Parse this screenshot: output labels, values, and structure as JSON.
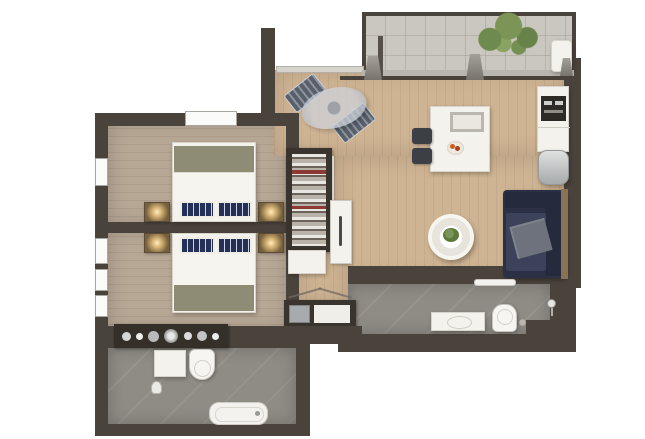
{
  "meta": {
    "title": "apartment-floor-plan",
    "view": "top-down-3d-render",
    "background": "#ffffff"
  },
  "palette": {
    "wall": "#4a433c",
    "window": "#fbfbfa",
    "bedroom_floor": "#b7a795",
    "living_floor": "#cfb493",
    "balcony_floor": "#cac7c0",
    "bath_floor": "#8f8b85",
    "furniture_white": "#f4f2ec",
    "bed_runner_olive": "#8f8c75",
    "duvet_white": "#f6f4ee",
    "pillow_navy": "#243055",
    "sofa_navy": "#2b3044",
    "sofa_seat": "#3c4259",
    "throw_gray": "#6d727c",
    "nightstand_wood": "#75603f",
    "lamp_glow": "#ffeebe",
    "chair_dark": "#3c4046",
    "counter_dark": "#352f2a",
    "appliance_dark": "#2e2b27",
    "fridge_steel": "#c0c2c3",
    "plant_green": "#7d9457",
    "coffee_plant_green": "#5d7a3a",
    "glass_table": "#b7bec9",
    "sofa_wood_frame": "#8a7254",
    "door_white": "#f4f2ed",
    "tray_gray": "#b9b7b0",
    "fruit_orange": "#cc5f1d"
  },
  "rooms": [
    {
      "id": "bedroom-1",
      "floor": "wood-plank-taupe",
      "features": [
        "window-left-wall",
        "window-top-wall"
      ]
    },
    {
      "id": "bedroom-2",
      "floor": "wood-plank-taupe",
      "features": [
        "windows-left-wall"
      ]
    },
    {
      "id": "bathroom-1",
      "floor": "gray-tile",
      "features": []
    },
    {
      "id": "hallway-living-dining",
      "floor": "wood-plank-light",
      "features": [
        "balcony-sliding-door"
      ]
    },
    {
      "id": "balcony",
      "floor": "gray-tile-grid",
      "features": [
        "railing"
      ]
    },
    {
      "id": "bathroom-2",
      "floor": "gray-tile",
      "features": []
    },
    {
      "id": "wardrobe-nook",
      "floor": "wood-plank-light",
      "features": []
    }
  ],
  "furniture": {
    "bedroom_1": [
      "double-bed",
      "olive-foot-runner",
      "two-striped-pillows",
      "nightstand-lamp-left",
      "nightstand-lamp-right"
    ],
    "bedroom_2": [
      "double-bed",
      "olive-foot-runner",
      "two-striped-pillows",
      "nightstand-lamp-left",
      "nightstand-lamp-right",
      "vanity-counter-accessories"
    ],
    "wardrobe_nook": [
      "open-wardrobe-hanging-clothes",
      "wardrobe-base-cabinet",
      "white-door-panel",
      "storage-bench-unit"
    ],
    "living_dining": [
      "glass-bistro-table",
      "bistro-chair-1",
      "bistro-chair-2",
      "dining-table",
      "serving-tray",
      "fruit-bowl",
      "dining-chair-1",
      "dining-chair-2",
      "round-coffee-table",
      "coffee-table-plant",
      "navy-sofa",
      "gray-throw",
      "kitchenette-tall-unit",
      "built-in-oven-microwave",
      "fridge"
    ],
    "balcony": [
      "green-plant",
      "white-lounger",
      "planter-1",
      "planter-2",
      "planter-3"
    ],
    "bathroom_1": [
      "vanity-cabinet",
      "toilet",
      "bathtub",
      "hand-shower"
    ],
    "bathroom_2": [
      "vanity-sink",
      "toilet",
      "shower-head",
      "glass-shelf",
      "floor-drain"
    ]
  }
}
